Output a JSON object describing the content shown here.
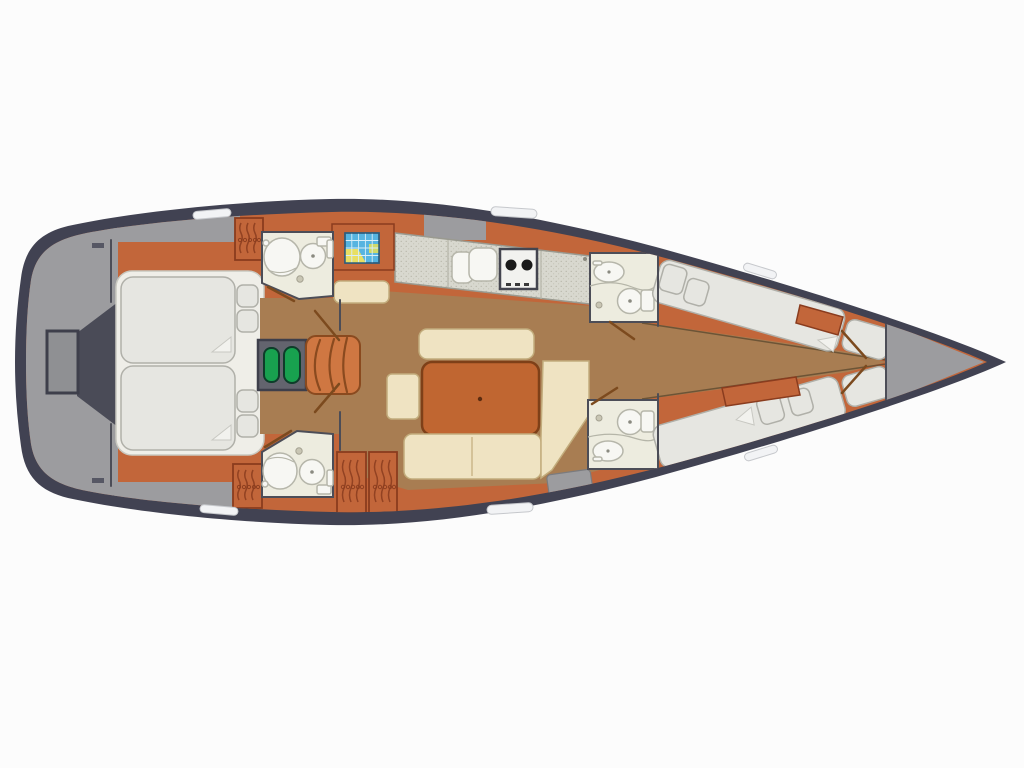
{
  "diagram": {
    "type": "yacht-interior-floor-plan",
    "orientation": "bow-right",
    "colors": {
      "bg": "#fcfcfc",
      "hull": "#414252",
      "deck": "#9c9c9f",
      "deck_dark": "#4a4b57",
      "deck_inner": "#8f9093",
      "orange": "#c2663a",
      "orange_dark": "#8a3c1e",
      "wood": "#a87d52",
      "cream": "#efe3c2",
      "cream_line": "#c2ac7c",
      "mattress": "#e6e6e1",
      "mattress_line": "#b0b0a9",
      "ivory": "#edecdf",
      "room_line": "#4c4d57",
      "counter": "#d8d8cf",
      "fixture": "#f7f7f3",
      "fixture_line": "#b6b6aa",
      "table": "#c06631",
      "table_line": "#7e4018",
      "green": "#18a14f",
      "map_blue": "#56b4e0",
      "map_yellow": "#e8df63",
      "window": "#f2f3f5",
      "door": "#7c4a1e"
    },
    "legend": [
      {
        "id": "swim-platform",
        "name": "Stern swim platform / transom gate"
      },
      {
        "id": "aft-cabin",
        "name": "Aft owner cabin with twin double berths and pillows"
      },
      {
        "id": "aft-head-top",
        "name": "Aft head: corner shower and toilet (top)"
      },
      {
        "id": "aft-head-bottom",
        "name": "Aft head: corner shower and toilet (bottom)"
      },
      {
        "id": "companionway",
        "name": "Companionway steps with engine box"
      },
      {
        "id": "nav-station",
        "name": "Navigation station with chart table and seat"
      },
      {
        "id": "galley",
        "name": "Galley with double sink and two-burner stove"
      },
      {
        "id": "salon",
        "name": "Salon with table, settee, stool and L-shaped sofa"
      },
      {
        "id": "hanging-lockers",
        "name": "Hanging lockers (4)"
      },
      {
        "id": "mid-head-top",
        "name": "Mid head: washbasin and toilet (top)"
      },
      {
        "id": "mid-head-bottom",
        "name": "Mid head: washbasin and toilet (bottom)"
      },
      {
        "id": "fwd-cabin-top",
        "name": "Forward cabin with angled berth (top)"
      },
      {
        "id": "fwd-cabin-bottom",
        "name": "Forward cabin with angled berth (bottom)"
      },
      {
        "id": "forepeak",
        "name": "Forepeak / anchor locker"
      },
      {
        "id": "hull-windows",
        "name": "Hull windows (6)"
      }
    ]
  }
}
